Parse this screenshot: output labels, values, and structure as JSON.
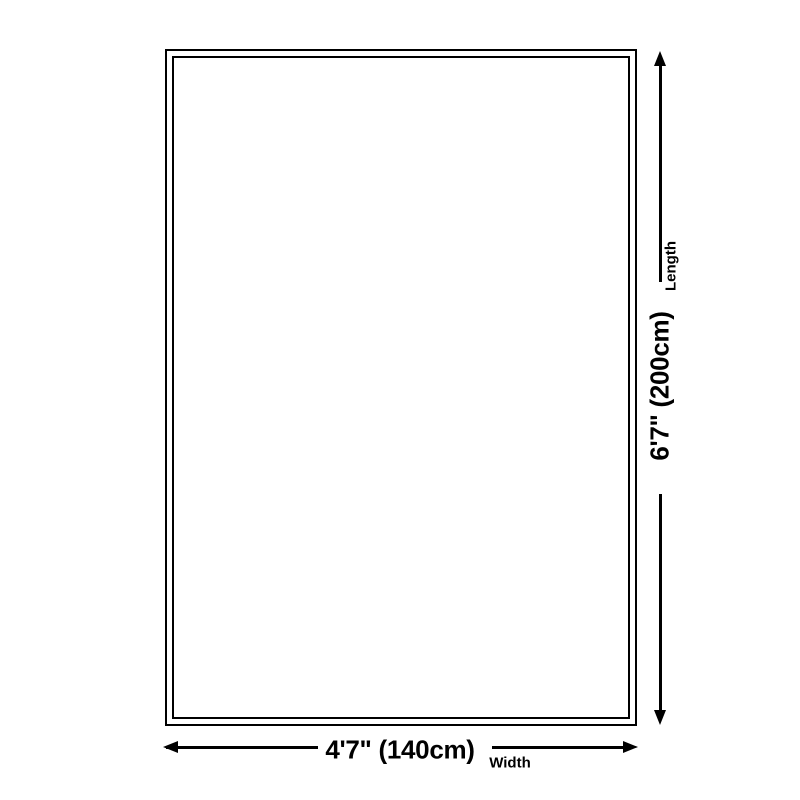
{
  "diagram": {
    "type": "product-size-diagram",
    "length": {
      "label": "Length",
      "value": "6'7\" (200cm)"
    },
    "width": {
      "label": "Width",
      "value": "4'7\" (140cm)"
    },
    "icons": {
      "arrow_up": "arrow-up-icon",
      "arrow_down": "arrow-down-icon",
      "arrow_left": "arrow-left-icon",
      "arrow_right": "arrow-right-icon"
    },
    "colors": {
      "ink": "#000000",
      "background": "#ffffff"
    }
  }
}
